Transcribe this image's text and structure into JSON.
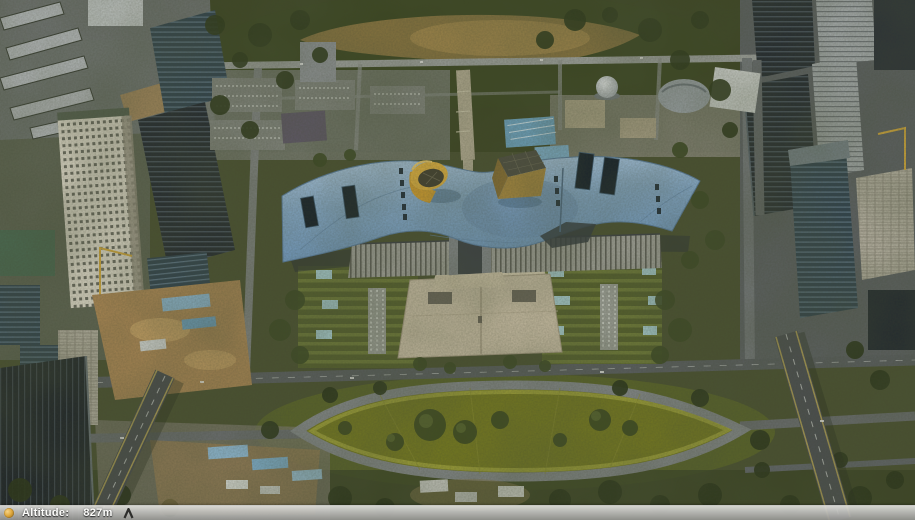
{
  "view": {
    "type": "3d-aerial-map-view"
  },
  "status_bar": {
    "altitude_label": "Altitude:",
    "altitude_value": "827m",
    "indicator_icon": "status-indicator-icon",
    "peak_icon": "mountain-peak-icon"
  },
  "colors": {
    "roof_blue": "#86abce",
    "cone_amber": "#e8b640",
    "gold_pavilion": "#a9893f",
    "lawn_olive": "#767a1f",
    "plaza_beige": "#cbbfa6",
    "vegetation_dark": "#39431f",
    "road_gray": "#5a5e60",
    "highway_edge_yellow": "#ab9b55",
    "statusbar_top": "#e0e0dd",
    "statusbar_bottom": "#969694",
    "dirt_tan": "#ab8754",
    "shed_blue": "#8fb9d4"
  }
}
